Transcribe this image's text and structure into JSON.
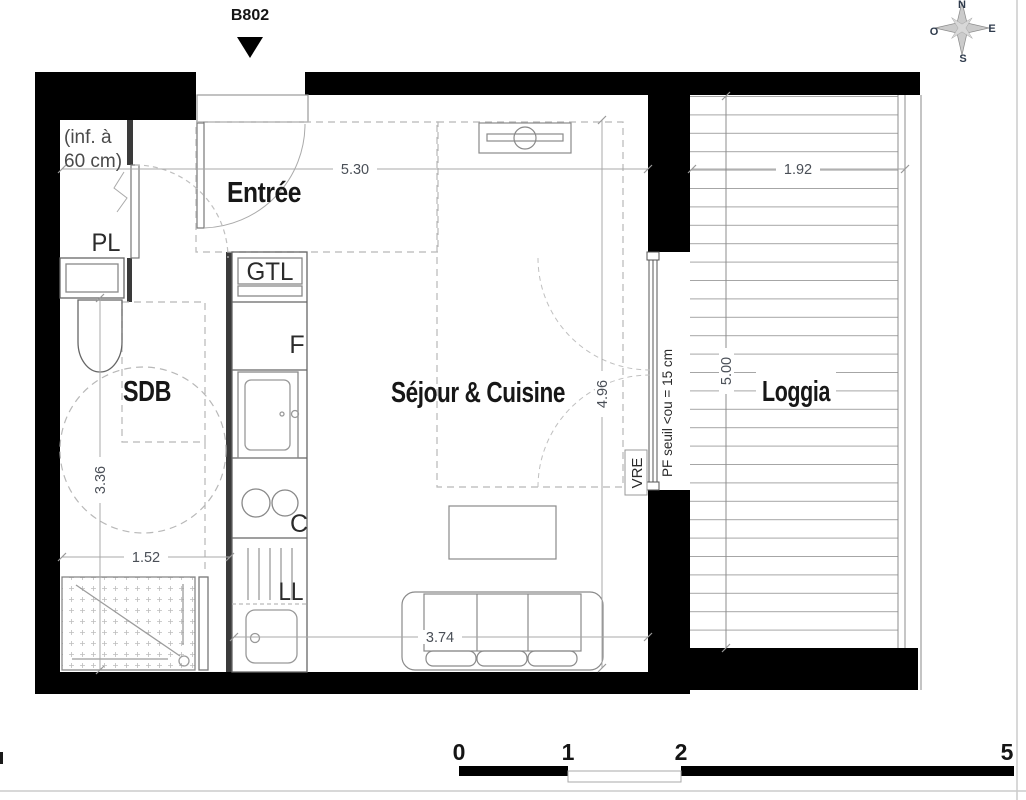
{
  "header": {
    "flat": "B802"
  },
  "rooms": {
    "entree": "Entrée",
    "sdb": "SDB",
    "sejour": "Séjour & Cuisine",
    "loggia": "Loggia"
  },
  "annotations": {
    "pl": "PL",
    "gtl": "GTL",
    "fridge": "F",
    "cooktop": "C",
    "washer": "LL",
    "vre": "VRE",
    "pf_seuil": "PF seuil <ou = 15 cm",
    "ceiling_note_line1": "(inf. à",
    "ceiling_note_line2": "60 cm)"
  },
  "dimensions": {
    "entree_width": "5.30",
    "loggia_width": "1.92",
    "sejour_depth": "4.96",
    "loggia_depth": "5.00",
    "sdb_depth": "3.36",
    "sdb_width": "1.52",
    "sejour_width": "3.74"
  },
  "compass": {
    "north": "N",
    "east": "E",
    "south": "S",
    "west": "O"
  },
  "scale_bar": {
    "tick0": "0",
    "tick1": "1",
    "tick2": "2",
    "tick5": "5"
  },
  "colors": {
    "wall": "#000000",
    "line": "#666666",
    "dashed": "#b8b8b8",
    "dim": "#a8a8a8"
  }
}
